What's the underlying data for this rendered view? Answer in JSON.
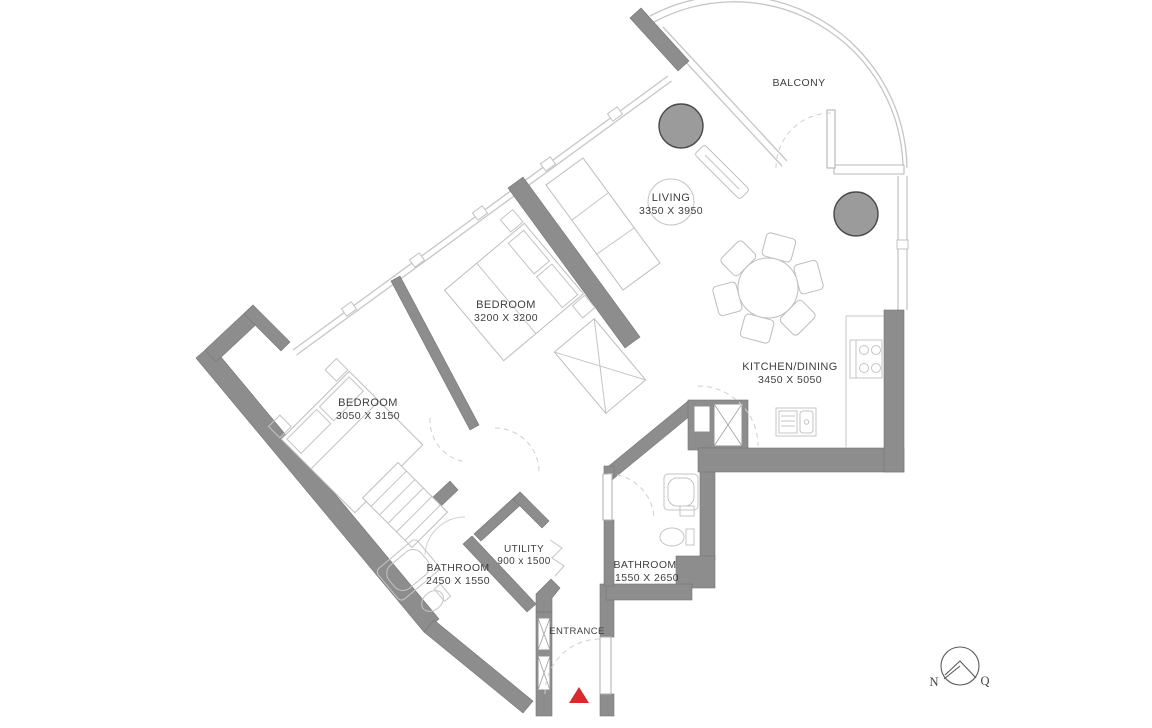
{
  "plan": {
    "rooms": [
      {
        "id": "balcony",
        "label": "BALCONY",
        "dims": ""
      },
      {
        "id": "living",
        "label": "LIVING",
        "dims": "3350 X 3950"
      },
      {
        "id": "bedroom1",
        "label": "BEDROOM",
        "dims": "3200 X 3200"
      },
      {
        "id": "bedroom2",
        "label": "BEDROOM",
        "dims": "3050 X 3150"
      },
      {
        "id": "kitchen",
        "label": "KITCHEN/DINING",
        "dims": "3450 X 5050"
      },
      {
        "id": "utility",
        "label": "UTILITY",
        "dims": "900 x 1500"
      },
      {
        "id": "bathroom1",
        "label": "BATHROOM",
        "dims": "2450 X 1550"
      },
      {
        "id": "bathroom2",
        "label": "BATHROOM",
        "dims": "1550 X 2650"
      },
      {
        "id": "entrance",
        "label": "ENTRANCE",
        "dims": ""
      }
    ],
    "compass": {
      "left": "N",
      "right": "Q"
    },
    "colors": {
      "wall": "#8d8d8d",
      "accent": "#d92b2b",
      "line": "#c6c6c6",
      "text": "#3f3f3f",
      "column": "#9b9b9b"
    }
  }
}
